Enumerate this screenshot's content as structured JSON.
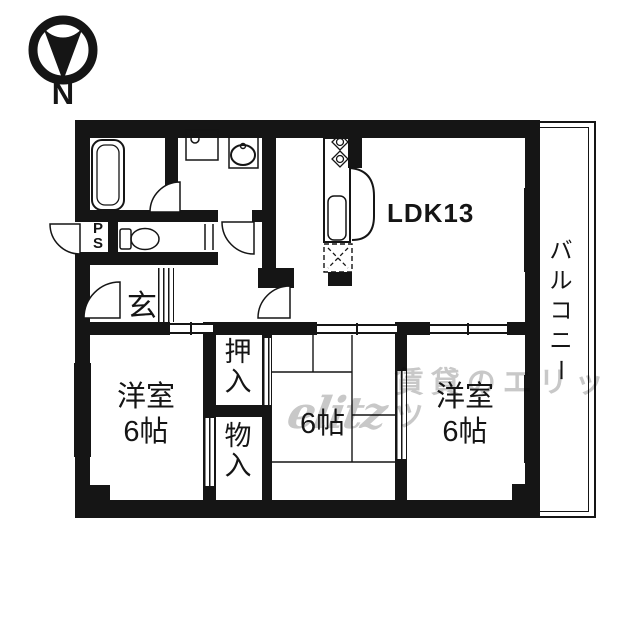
{
  "compass": {
    "north": "N"
  },
  "labels": {
    "ldk": "LDK13",
    "genkan": "玄",
    "ps": [
      "P",
      "S"
    ],
    "oshiire": [
      "押",
      "入"
    ],
    "monoire": [
      "物",
      "入"
    ],
    "west_left": [
      "洋室",
      "6帖"
    ],
    "tatami": "6帖",
    "west_right": [
      "洋室",
      "6帖"
    ],
    "balcony": [
      "バ",
      "ル",
      "コ",
      "ニ",
      "ー"
    ]
  },
  "watermark": {
    "logo": "elitz",
    "text": "賃貸のエリッツ"
  },
  "colors": {
    "ink": "#151515",
    "bg": "#ffffff",
    "watermark": "#c8c8c8"
  }
}
